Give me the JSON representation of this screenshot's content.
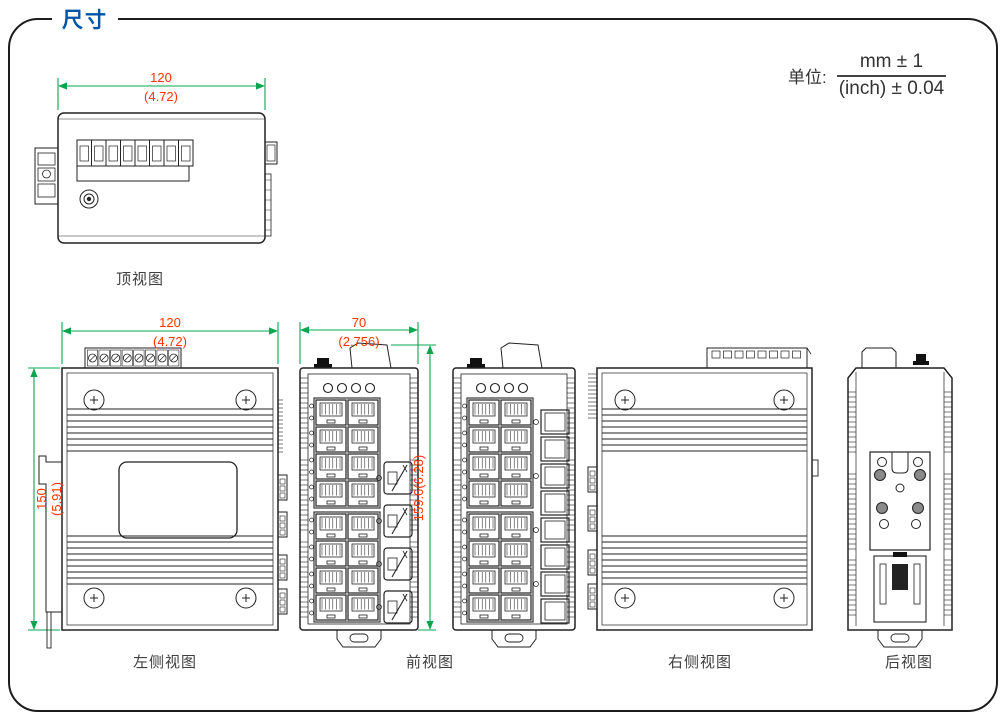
{
  "page": {
    "title": "尺寸"
  },
  "unit_note": {
    "label": "单位:",
    "numerator": "mm ± 1",
    "denominator": "(inch) ± 0.04"
  },
  "views": {
    "top": {
      "label": "顶视图",
      "dim_width": {
        "mm": "120",
        "inch": "(4.72)"
      }
    },
    "left_side": {
      "label": "左侧视图",
      "dim_width": {
        "mm": "120",
        "inch": "(4.72)"
      },
      "dim_height": {
        "mm": "150",
        "inch": "(5.91)"
      }
    },
    "front": {
      "label": "前视图",
      "dim_width": {
        "mm": "70",
        "inch": "(2.756)"
      },
      "dim_height_combined": "159.6(6.28)",
      "led_count": 4,
      "rj45_ports": 16,
      "sfp_ports": 4
    },
    "front_alt": {
      "led_count": 4,
      "rj45_ports": 16,
      "square_ports": 8
    },
    "right_side": {
      "label": "右侧视图"
    },
    "rear": {
      "label": "后视图"
    }
  },
  "colors": {
    "dim_line": "#0AA64F",
    "dim_text": "#FF3300",
    "title": "#0054A6",
    "outline": "#222222"
  }
}
